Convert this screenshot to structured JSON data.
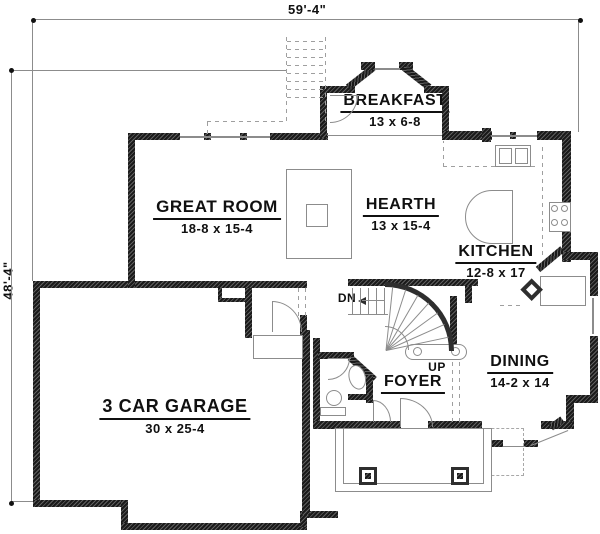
{
  "dimensions": {
    "top": "59'-4\"",
    "left": "48'-4\""
  },
  "rooms": {
    "breakfast": {
      "name": "BREAKFAST",
      "size": "13 x 6-8"
    },
    "great_room": {
      "name": "GREAT ROOM",
      "size": "18-8 x 15-4"
    },
    "hearth": {
      "name": "HEARTH",
      "size": "13 x 15-4"
    },
    "kitchen": {
      "name": "KITCHEN",
      "size": "12-8 x 17"
    },
    "dining": {
      "name": "DINING",
      "size": "14-2 x 14"
    },
    "foyer": {
      "name": "FOYER"
    },
    "garage": {
      "name": "3 CAR GARAGE",
      "size": "30 x 25-4"
    }
  },
  "stairs": {
    "down": "DN",
    "up": "UP"
  },
  "colors": {
    "wall": "#2e2e2e",
    "line": "#8c8c8c",
    "dash": "#aaaaaa",
    "text": "#101010",
    "background": "#ffffff"
  }
}
